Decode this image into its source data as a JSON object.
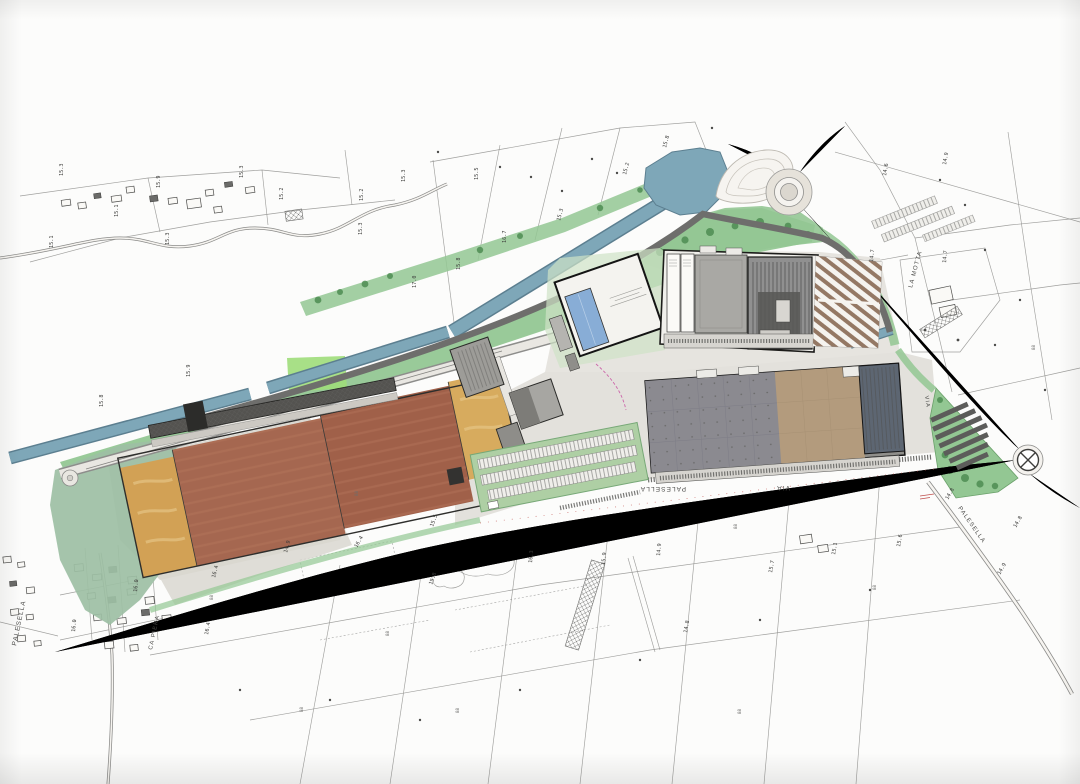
{
  "document": {
    "kind": "scanned masterplan site plan on white paper",
    "base_map": "cadastral line map with spot elevations"
  },
  "colors": {
    "paper": "#fcfcfb",
    "line": "#8f8f8d",
    "canal": "#7ea7b8",
    "canalEdge": "#5c7f90",
    "green": "#93c793",
    "greenPale": "#aecfa4",
    "sage": "#9dbfa4",
    "greenBright": "#9fdd7a",
    "tree": "#4e8c52",
    "field": "#a56750",
    "fieldAlt": "#a06049",
    "fieldTan": "#d2a155",
    "pool": "#88add6",
    "roofTan": "#b39b7d",
    "roofSlate": "#5d6672",
    "roadCase": "#7e7e7c",
    "roadFill": "#f4f2ee",
    "parkBrown": "#7d5a43",
    "redMark": "#c0504d",
    "magenta": "#cc66aa"
  },
  "labels": {
    "streets": [
      {
        "text": "PALESELLA",
        "x": 16,
        "y": 646,
        "rot": -78
      },
      {
        "text": "CA PIERA",
        "x": 152,
        "y": 650,
        "rot": -78,
        "size": 5.8
      },
      {
        "text": "PALESELLA",
        "x": 686,
        "y": 487,
        "rot": 180
      },
      {
        "text": "VIA",
        "x": 790,
        "y": 486,
        "rot": 180
      },
      {
        "text": "VIA",
        "x": 925,
        "y": 396,
        "rot": 82,
        "size": 5.5
      },
      {
        "text": "PALESELLA",
        "x": 958,
        "y": 508,
        "rot": 55,
        "size": 6
      },
      {
        "text": "LA MOTTA",
        "x": 912,
        "y": 288,
        "rot": -75,
        "size": 6
      }
    ],
    "elevations": [
      {
        "text": "15.3",
        "x": 63,
        "y": 176,
        "rot": -90
      },
      {
        "text": "15.9",
        "x": 160,
        "y": 188,
        "rot": -90
      },
      {
        "text": "15.3",
        "x": 243,
        "y": 178,
        "rot": -90
      },
      {
        "text": "15.2",
        "x": 283,
        "y": 200,
        "rot": -90
      },
      {
        "text": "15.1",
        "x": 118,
        "y": 217,
        "rot": -90
      },
      {
        "text": "15.1",
        "x": 53,
        "y": 248,
        "rot": -90
      },
      {
        "text": "15.3",
        "x": 169,
        "y": 245,
        "rot": -90
      },
      {
        "text": "15.3",
        "x": 405,
        "y": 182,
        "rot": -90
      },
      {
        "text": "15.5",
        "x": 478,
        "y": 180,
        "rot": -90
      },
      {
        "text": "15.2",
        "x": 363,
        "y": 201,
        "rot": -90
      },
      {
        "text": "15.3",
        "x": 362,
        "y": 235,
        "rot": -90
      },
      {
        "text": "16.7",
        "x": 506,
        "y": 243,
        "rot": -90
      },
      {
        "text": "15.8",
        "x": 460,
        "y": 270,
        "rot": -90
      },
      {
        "text": "17.0",
        "x": 416,
        "y": 288,
        "rot": -90
      },
      {
        "text": "15.3",
        "x": 560,
        "y": 221,
        "rot": -75
      },
      {
        "text": "15.2",
        "x": 626,
        "y": 175,
        "rot": -75
      },
      {
        "text": "15.8",
        "x": 666,
        "y": 148,
        "rot": -75
      },
      {
        "text": "14.6",
        "x": 886,
        "y": 176,
        "rot": -80
      },
      {
        "text": "14.9",
        "x": 946,
        "y": 165,
        "rot": -80
      },
      {
        "text": "14.7",
        "x": 873,
        "y": 262,
        "rot": -85
      },
      {
        "text": "14.7",
        "x": 946,
        "y": 263,
        "rot": -85
      },
      {
        "text": "15.9",
        "x": 190,
        "y": 377,
        "rot": -90
      },
      {
        "text": "15.8",
        "x": 103,
        "y": 407,
        "rot": -90
      },
      {
        "text": "16.4",
        "x": 357,
        "y": 548,
        "rot": -60
      },
      {
        "text": "16.4",
        "x": 215,
        "y": 578,
        "rot": -75
      },
      {
        "text": "14.9",
        "x": 287,
        "y": 553,
        "rot": -75
      },
      {
        "text": "16.0",
        "x": 137,
        "y": 592,
        "rot": -85
      },
      {
        "text": "15.5",
        "x": 433,
        "y": 527,
        "rot": -70
      },
      {
        "text": "15.8",
        "x": 432,
        "y": 585,
        "rot": -70
      },
      {
        "text": "14.9",
        "x": 660,
        "y": 556,
        "rot": -85
      },
      {
        "text": "15.7",
        "x": 772,
        "y": 573,
        "rot": -80
      },
      {
        "text": "15.1",
        "x": 835,
        "y": 555,
        "rot": -80
      },
      {
        "text": "15.6",
        "x": 900,
        "y": 547,
        "rot": -80
      },
      {
        "text": "14.9",
        "x": 1000,
        "y": 575,
        "rot": -60
      },
      {
        "text": "14.8",
        "x": 1016,
        "y": 528,
        "rot": -60
      },
      {
        "text": "14.8",
        "x": 948,
        "y": 500,
        "rot": -60
      },
      {
        "text": "16.3",
        "x": 532,
        "y": 563,
        "rot": -85
      },
      {
        "text": "15.9",
        "x": 605,
        "y": 565,
        "rot": -85
      },
      {
        "text": "14.8",
        "x": 687,
        "y": 633,
        "rot": -80
      },
      {
        "text": "16.4",
        "x": 208,
        "y": 635,
        "rot": -80
      },
      {
        "text": "16.0",
        "x": 75,
        "y": 632,
        "rot": -85
      }
    ],
    "parcel_marks": [
      {
        "text": "88",
        "x": 213,
        "y": 600,
        "rot": -90
      },
      {
        "text": "88",
        "x": 358,
        "y": 496,
        "rot": -90
      },
      {
        "text": "88",
        "x": 737,
        "y": 529,
        "rot": -90
      },
      {
        "text": "88",
        "x": 876,
        "y": 590,
        "rot": -90
      },
      {
        "text": "88",
        "x": 1035,
        "y": 350,
        "rot": -90
      },
      {
        "text": "88",
        "x": 389,
        "y": 636,
        "rot": -90
      },
      {
        "text": "88",
        "x": 459,
        "y": 713,
        "rot": -90
      },
      {
        "text": "88",
        "x": 741,
        "y": 714,
        "rot": -90
      },
      {
        "text": "88",
        "x": 303,
        "y": 712,
        "rot": -90
      }
    ]
  }
}
